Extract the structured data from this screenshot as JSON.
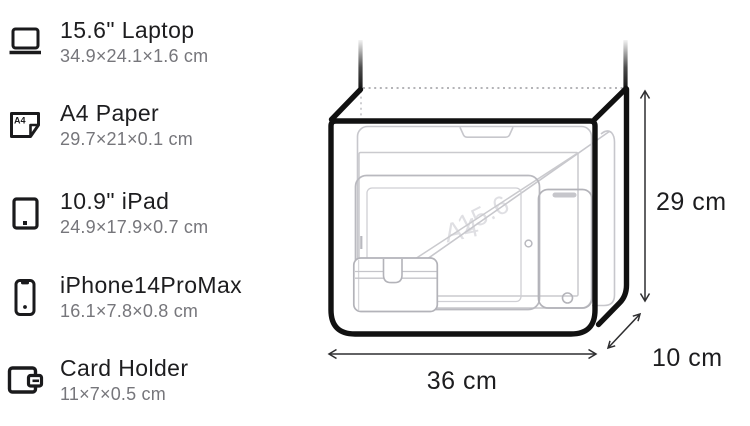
{
  "legend": {
    "items": [
      {
        "icon": "laptop-icon",
        "title": "15.6\" Laptop",
        "dims": "34.9×24.1×1.6 cm"
      },
      {
        "icon": "a4-paper-icon",
        "title": "A4 Paper",
        "dims": "29.7×21×0.1 cm",
        "icon_label": "A4"
      },
      {
        "icon": "ipad-icon",
        "title": "10.9\" iPad",
        "dims": "24.9×17.9×0.7 cm"
      },
      {
        "icon": "iphone-icon",
        "title": "iPhone14ProMax",
        "dims": "16.1×7.8×0.8 cm"
      },
      {
        "icon": "card-holder-icon",
        "title": "Card Holder",
        "dims": "11×7×0.5 cm"
      }
    ]
  },
  "diagram": {
    "width_label": "36 cm",
    "height_label": "29 cm",
    "depth_label": "10 cm",
    "watermark_a4": "A4",
    "watermark_laptop": "15.6"
  },
  "colors": {
    "outline": "#111111",
    "item_stroke_light": "#c7c7cc",
    "item_stroke_dark": "#b3b3b9",
    "text_primary": "#1d1d1f",
    "text_secondary": "#76767b"
  }
}
